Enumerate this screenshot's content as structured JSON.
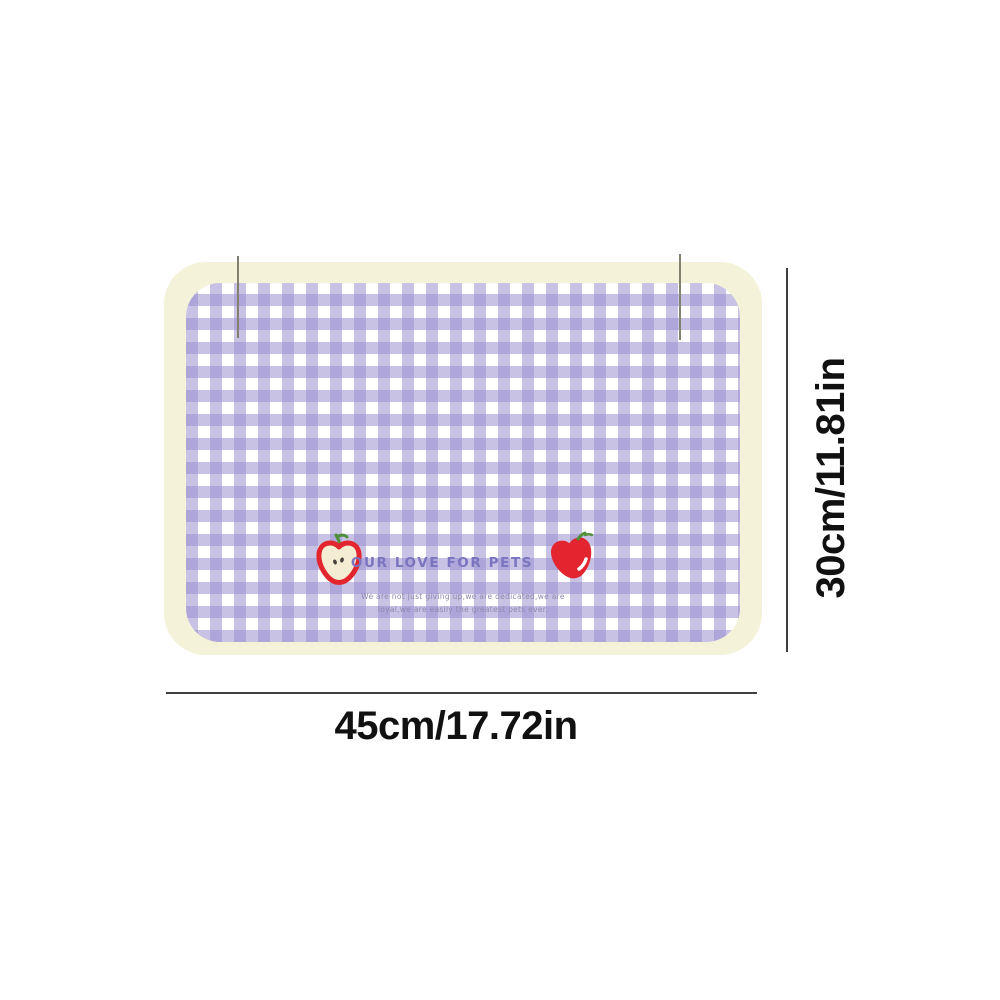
{
  "product": {
    "brand_text": "OUR LOVE FOR PETS",
    "tagline_line1": "We are not just giving up,we are dedicated,we are",
    "tagline_line2": "loyal,we are easily the greatest pets ever.",
    "pattern": "lavender-gingham-check",
    "decorations": [
      {
        "icon": "cut-apple-icon"
      },
      {
        "icon": "red-apple-icon"
      }
    ]
  },
  "dimensions": {
    "width_label": "45cm/17.72in",
    "height_label": "30cm/11.81in"
  },
  "colors": {
    "background": "#ffffff",
    "mat_border_cream": "#f4f2d9",
    "gingham_lavender": "#c6bfe2",
    "gingham_overlap": "#aaa2d4",
    "brand_text_purple": "#7b74c0",
    "tagline_purple": "#8f88ad",
    "apple_red": "#e2252e",
    "apple_flesh": "#f4edd3",
    "stem_green": "#4f9038",
    "dimension_ink": "#3f3f3f"
  }
}
